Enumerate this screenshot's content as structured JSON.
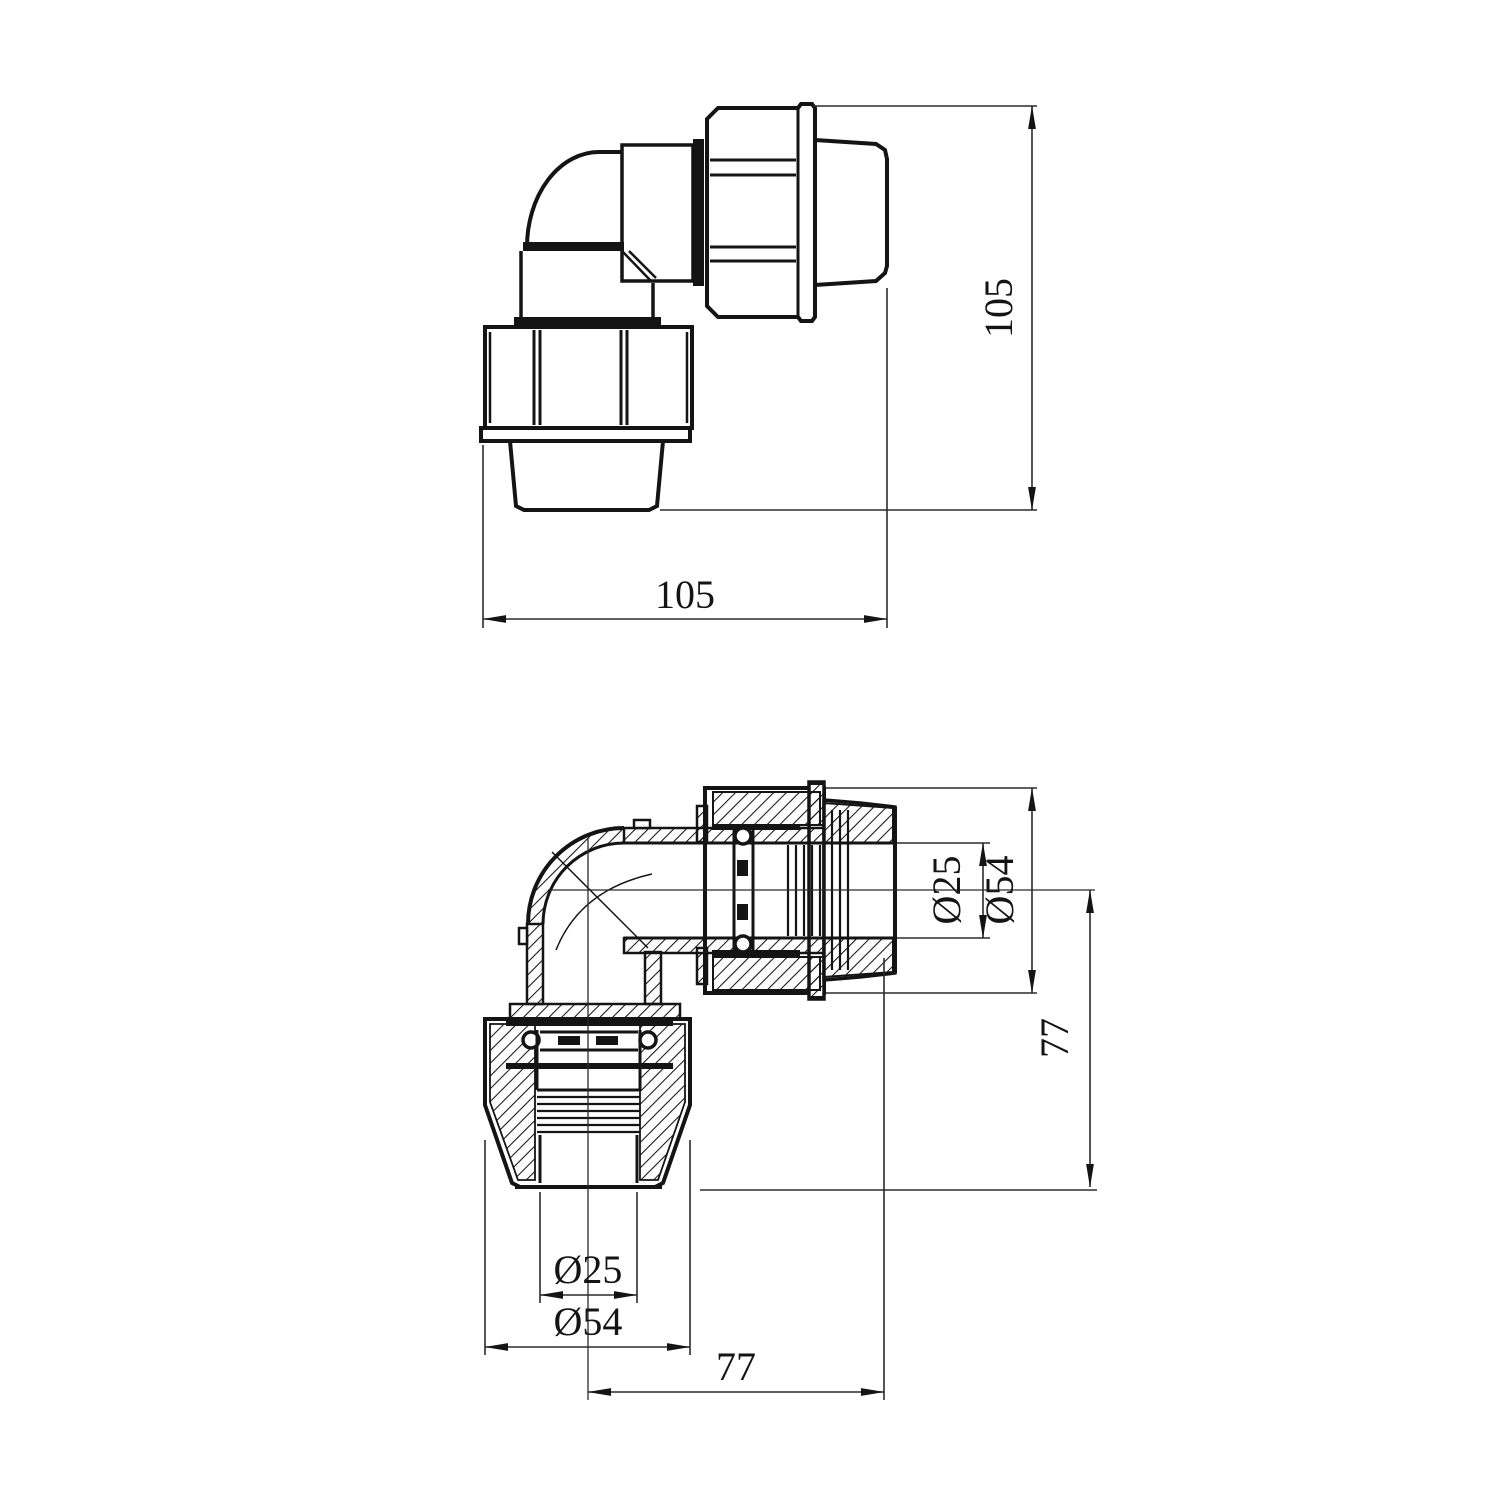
{
  "style": {
    "background": "#ffffff",
    "line_color": "#141414",
    "dim_line_color": "#2b2b2b"
  },
  "drawing": {
    "views": [
      {
        "id": "top-view",
        "kind": "external-elevation"
      },
      {
        "id": "section-view",
        "kind": "cross-section"
      }
    ]
  },
  "labels": {
    "top_width": "105",
    "top_height": "105",
    "sec_bore_right": "Ø25",
    "sec_od_right": "Ø54",
    "sec_height_right": "77",
    "sec_bore_bottom": "Ø25",
    "sec_od_bottom": "Ø54",
    "sec_width_bottom": "77"
  }
}
